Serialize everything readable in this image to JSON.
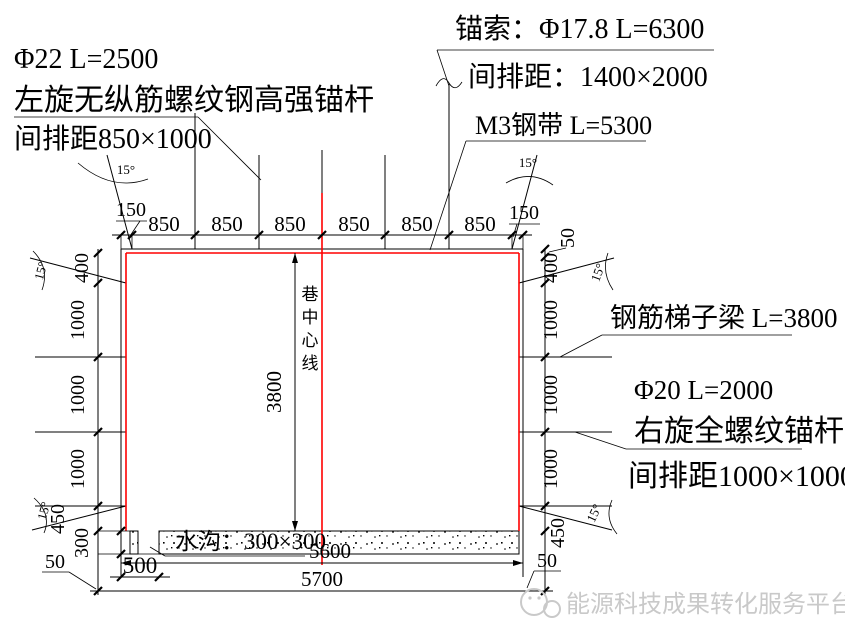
{
  "annotations": {
    "top_left": {
      "line1": "Φ22  L=2500",
      "line2": "左旋无纵筋螺纹钢高强锚杆",
      "line3": "间排距850×1000"
    },
    "top_center": {
      "line1": "锚索：Φ17.8  L=6300",
      "line2": "间排距：1400×2000",
      "line3": "M3钢带 L=5300"
    },
    "right": {
      "line1": "钢筋梯子梁 L=3800",
      "line2": "Φ20 L=2000",
      "line3": "右旋全螺纹锚杆",
      "line4": "间排距1000×1000"
    },
    "center_line_label": "巷中心线",
    "ditch_label": "水沟：300×300"
  },
  "dims": {
    "top": [
      "150",
      "850",
      "850",
      "850",
      "850",
      "850",
      "850",
      "150"
    ],
    "left": [
      "400",
      "1000",
      "1000",
      "1000",
      "450",
      "300"
    ],
    "right": [
      "50",
      "400",
      "1000",
      "1000",
      "1000",
      "450"
    ],
    "height": "3800",
    "width_inner": "5600",
    "width_outer": "5700",
    "ditch_offset": "500",
    "gap50": "50",
    "angle": "15°"
  },
  "watermark": {
    "text": "能源科技成果转化服务平台"
  },
  "colors": {
    "outline_red": "#ff0000",
    "line_black": "#000000",
    "watermark_gray": "#c9c9c9"
  }
}
